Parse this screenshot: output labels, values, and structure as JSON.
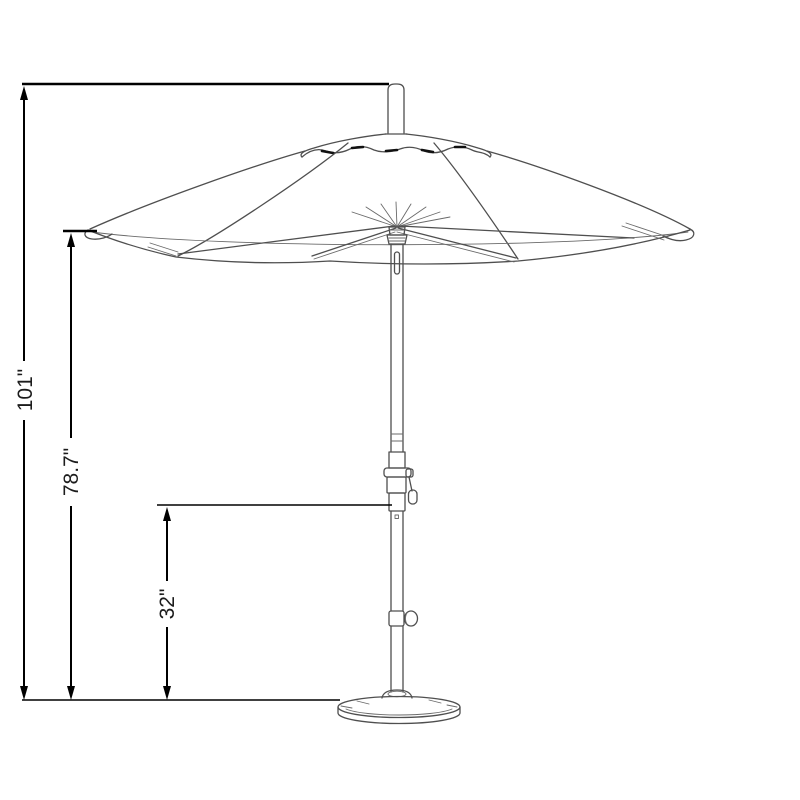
{
  "page": {
    "background": "#ffffff"
  },
  "diagram": {
    "subject": "market patio umbrella with crank, tilt knob and round base",
    "colors": {
      "artwork_stroke": "#4f4f4f",
      "dimension_stroke": "#000000",
      "label_text": "#1c1c1c"
    },
    "dimensions": [
      {
        "name": "overall-height",
        "label": "101\""
      },
      {
        "name": "height-to-canopy-edge",
        "label": "78.7\""
      },
      {
        "name": "height-to-lower-pole",
        "label": "32\""
      }
    ]
  }
}
